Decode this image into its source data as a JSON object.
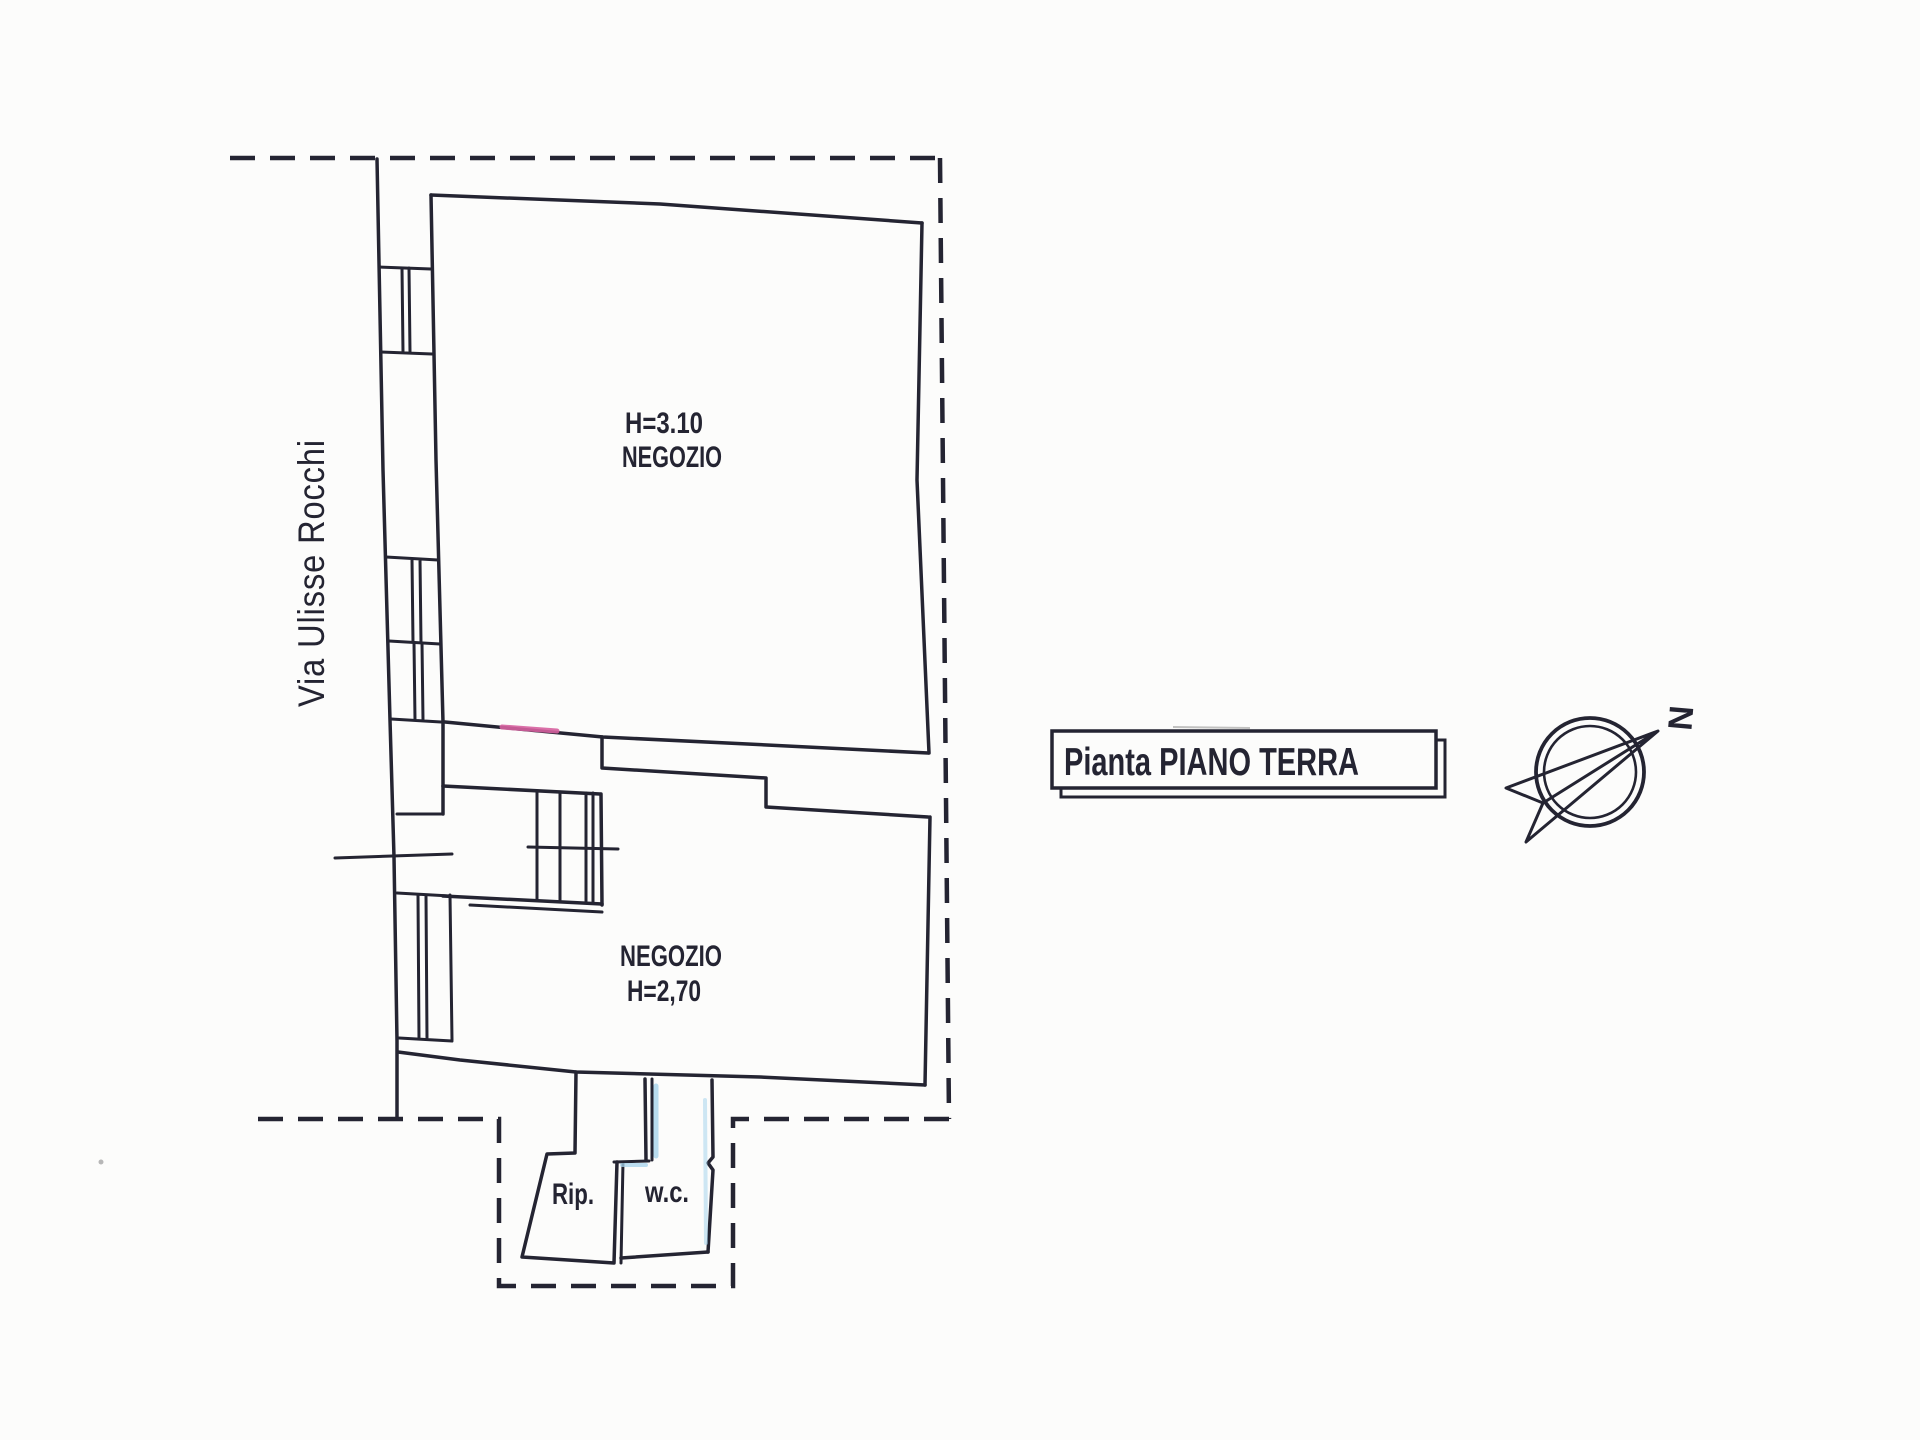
{
  "street_label": "Via Ulisse Rocchi",
  "rooms": {
    "shop_upper": {
      "height": "H=3.10",
      "name": "NEGOZIO"
    },
    "shop_lower": {
      "name": "NEGOZIO",
      "height": "H=2,70"
    },
    "storage": {
      "name": "Rip."
    },
    "wc": {
      "name": "w.c."
    }
  },
  "title_box": {
    "text": "Pianta PIANO TERRA"
  },
  "compass": {
    "north_label": "N"
  },
  "colors": {
    "ink": "#242432",
    "paper": "#fcfcfb",
    "pink": "#d6609f",
    "blue": "#a6d3ec",
    "muted": "#9a9a9a"
  }
}
